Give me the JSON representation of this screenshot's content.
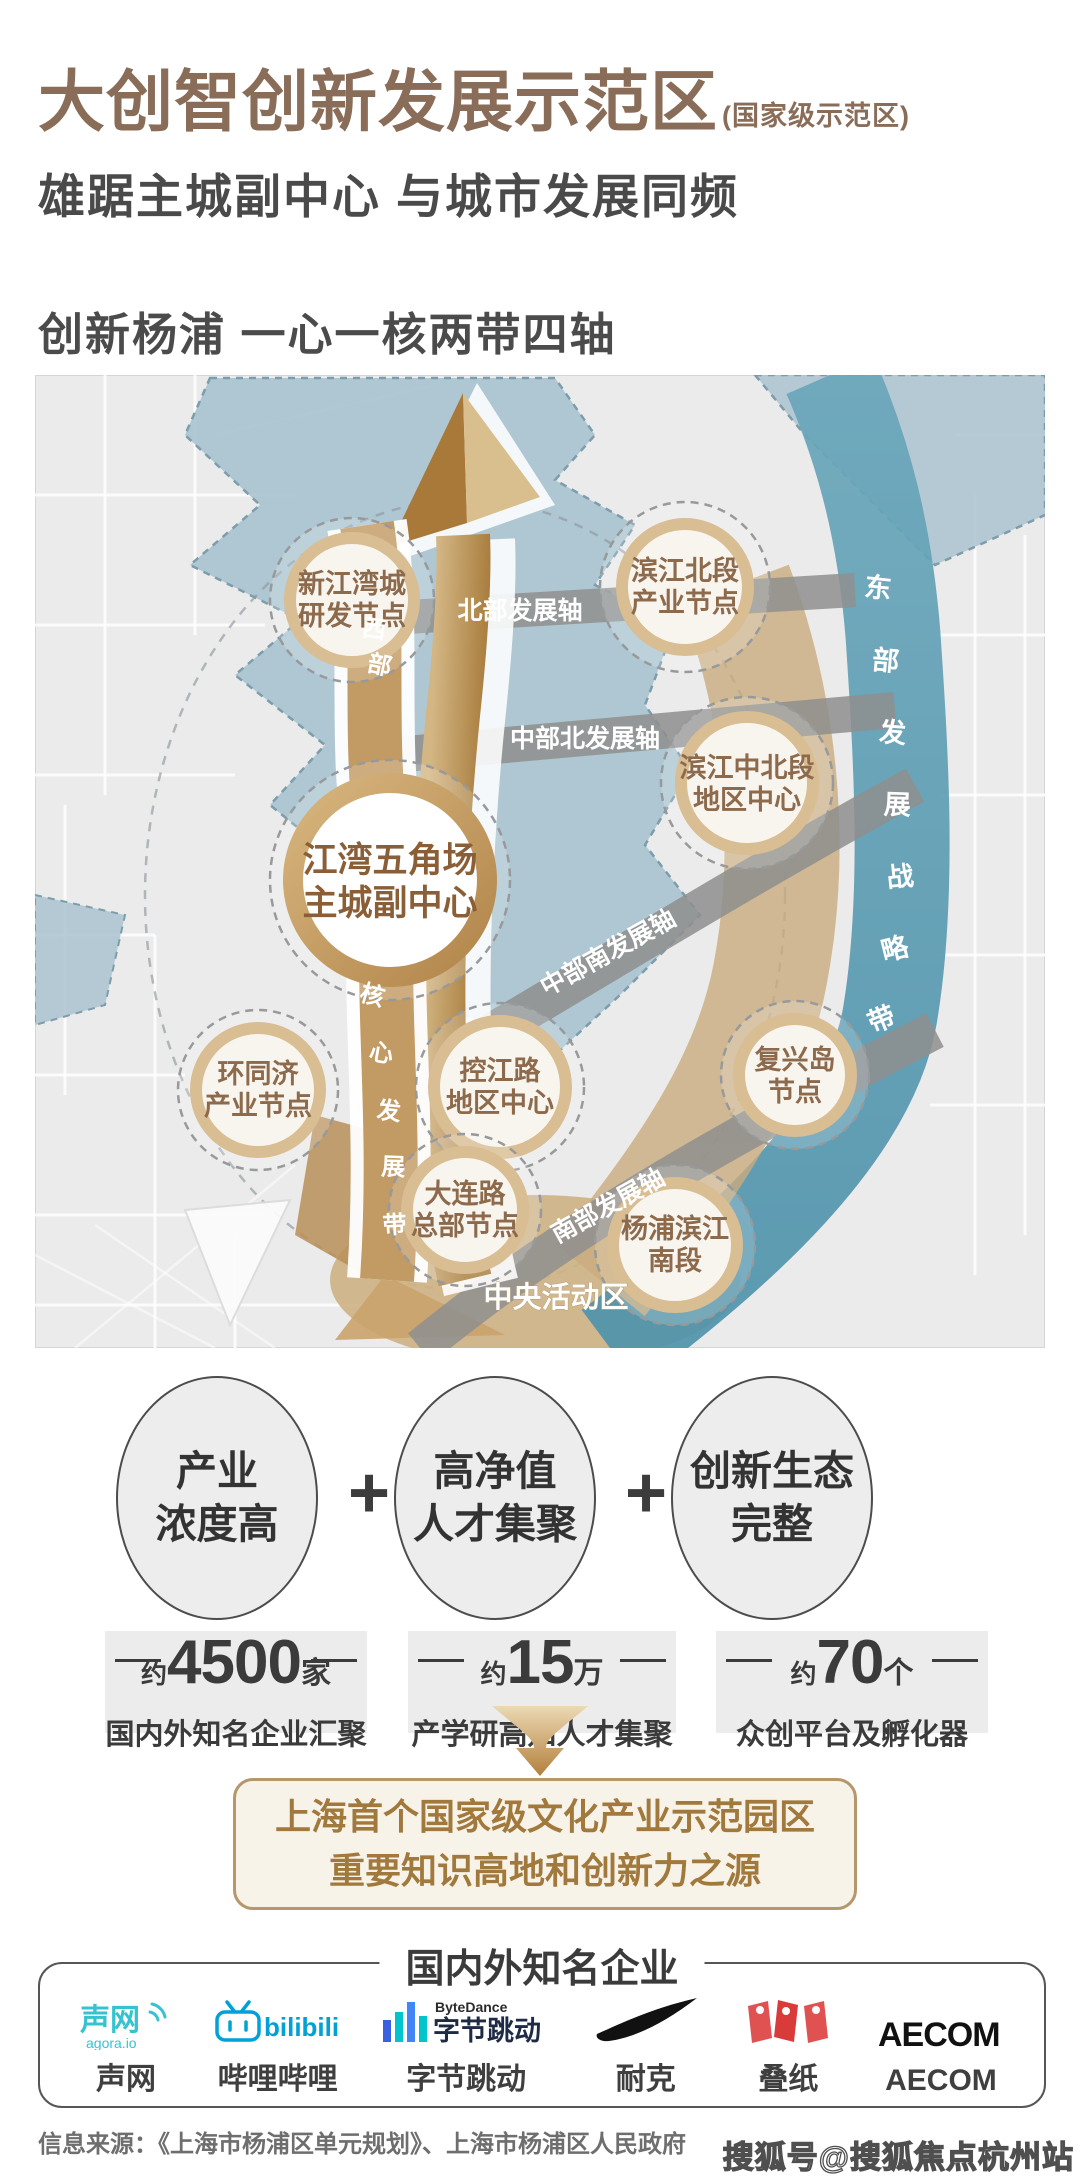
{
  "header": {
    "title": "大创智创新发展示范区",
    "title_suffix": "(国家级示范区)",
    "subtitle": "雄踞主城副中心 与城市发展同频"
  },
  "section_title": "创新杨浦 一心一核两带四轴",
  "map": {
    "nodes": [
      {
        "l1": "新江湾城",
        "l2": "研发节点"
      },
      {
        "l1": "滨江北段",
        "l2": "产业节点"
      },
      {
        "l1": "江湾五角场",
        "l2": "主城副中心"
      },
      {
        "l1": "滨江中北段",
        "l2": "地区中心"
      },
      {
        "l1": "环同济",
        "l2": "产业节点"
      },
      {
        "l1": "控江路",
        "l2": "地区中心"
      },
      {
        "l1": "复兴岛",
        "l2": "节点"
      },
      {
        "l1": "大连路",
        "l2": "总部节点"
      },
      {
        "l1": "杨浦滨江",
        "l2": "南段"
      }
    ],
    "axes": {
      "north": "北部发展轴",
      "mid_north": "中部北发展轴",
      "mid_south": "中部南发展轴",
      "south": "南部发展轴"
    },
    "west_chars": [
      "西",
      "部"
    ],
    "core_chars": [
      "核",
      "心",
      "发",
      "展",
      "带"
    ],
    "east_chars": [
      "东",
      "部",
      "发",
      "展",
      "战",
      "略",
      "带"
    ],
    "cad": "中央活动区"
  },
  "features": {
    "plus": "+",
    "items": [
      {
        "l1": "产业",
        "l2": "浓度高"
      },
      {
        "l1": "高净值",
        "l2": "人才集聚"
      },
      {
        "l1": "创新生态",
        "l2": "完整"
      }
    ]
  },
  "stats": {
    "items": [
      {
        "prefix": "约",
        "value": "4500",
        "unit": "家",
        "desc": "国内外知名企业汇聚"
      },
      {
        "prefix": "约",
        "value": "15",
        "unit": "万",
        "desc": "产学研高知人才集聚"
      },
      {
        "prefix": "约",
        "value": "70",
        "unit": "个",
        "desc": "众创平台及孵化器"
      }
    ]
  },
  "highlight": {
    "l1": "上海首个国家级文化产业示范园区",
    "l2": "重要知识高地和创新力之源"
  },
  "companies": {
    "title": "国内外知名企业",
    "names": [
      "声网",
      "哔哩哔哩",
      "字节跳动",
      "耐克",
      "叠纸",
      "AECOM"
    ],
    "logo_texts": {
      "agora_cn": "声网",
      "agora_sub": "agora.io",
      "bilibili": "bilibili",
      "bytedance_en": "ByteDance",
      "bytedance_cn": "字节跳动",
      "aecom": "AECOM"
    }
  },
  "footer": {
    "source": "信息来源：《上海市杨浦区单元规划》、上海市杨浦区人民政府",
    "watermark": "搜狐号@搜狐焦点杭州站"
  },
  "colors": {
    "brand_brown": "#8a6d58",
    "node_text": "#8d6a4c",
    "gold": "#b0854a",
    "river_teal": "#5b9cb3",
    "band_gray": "#8f8f8f",
    "blue_zone": "#a6c1ce",
    "tan": "#c9ab7e",
    "text_dark": "#3b3b3b"
  }
}
